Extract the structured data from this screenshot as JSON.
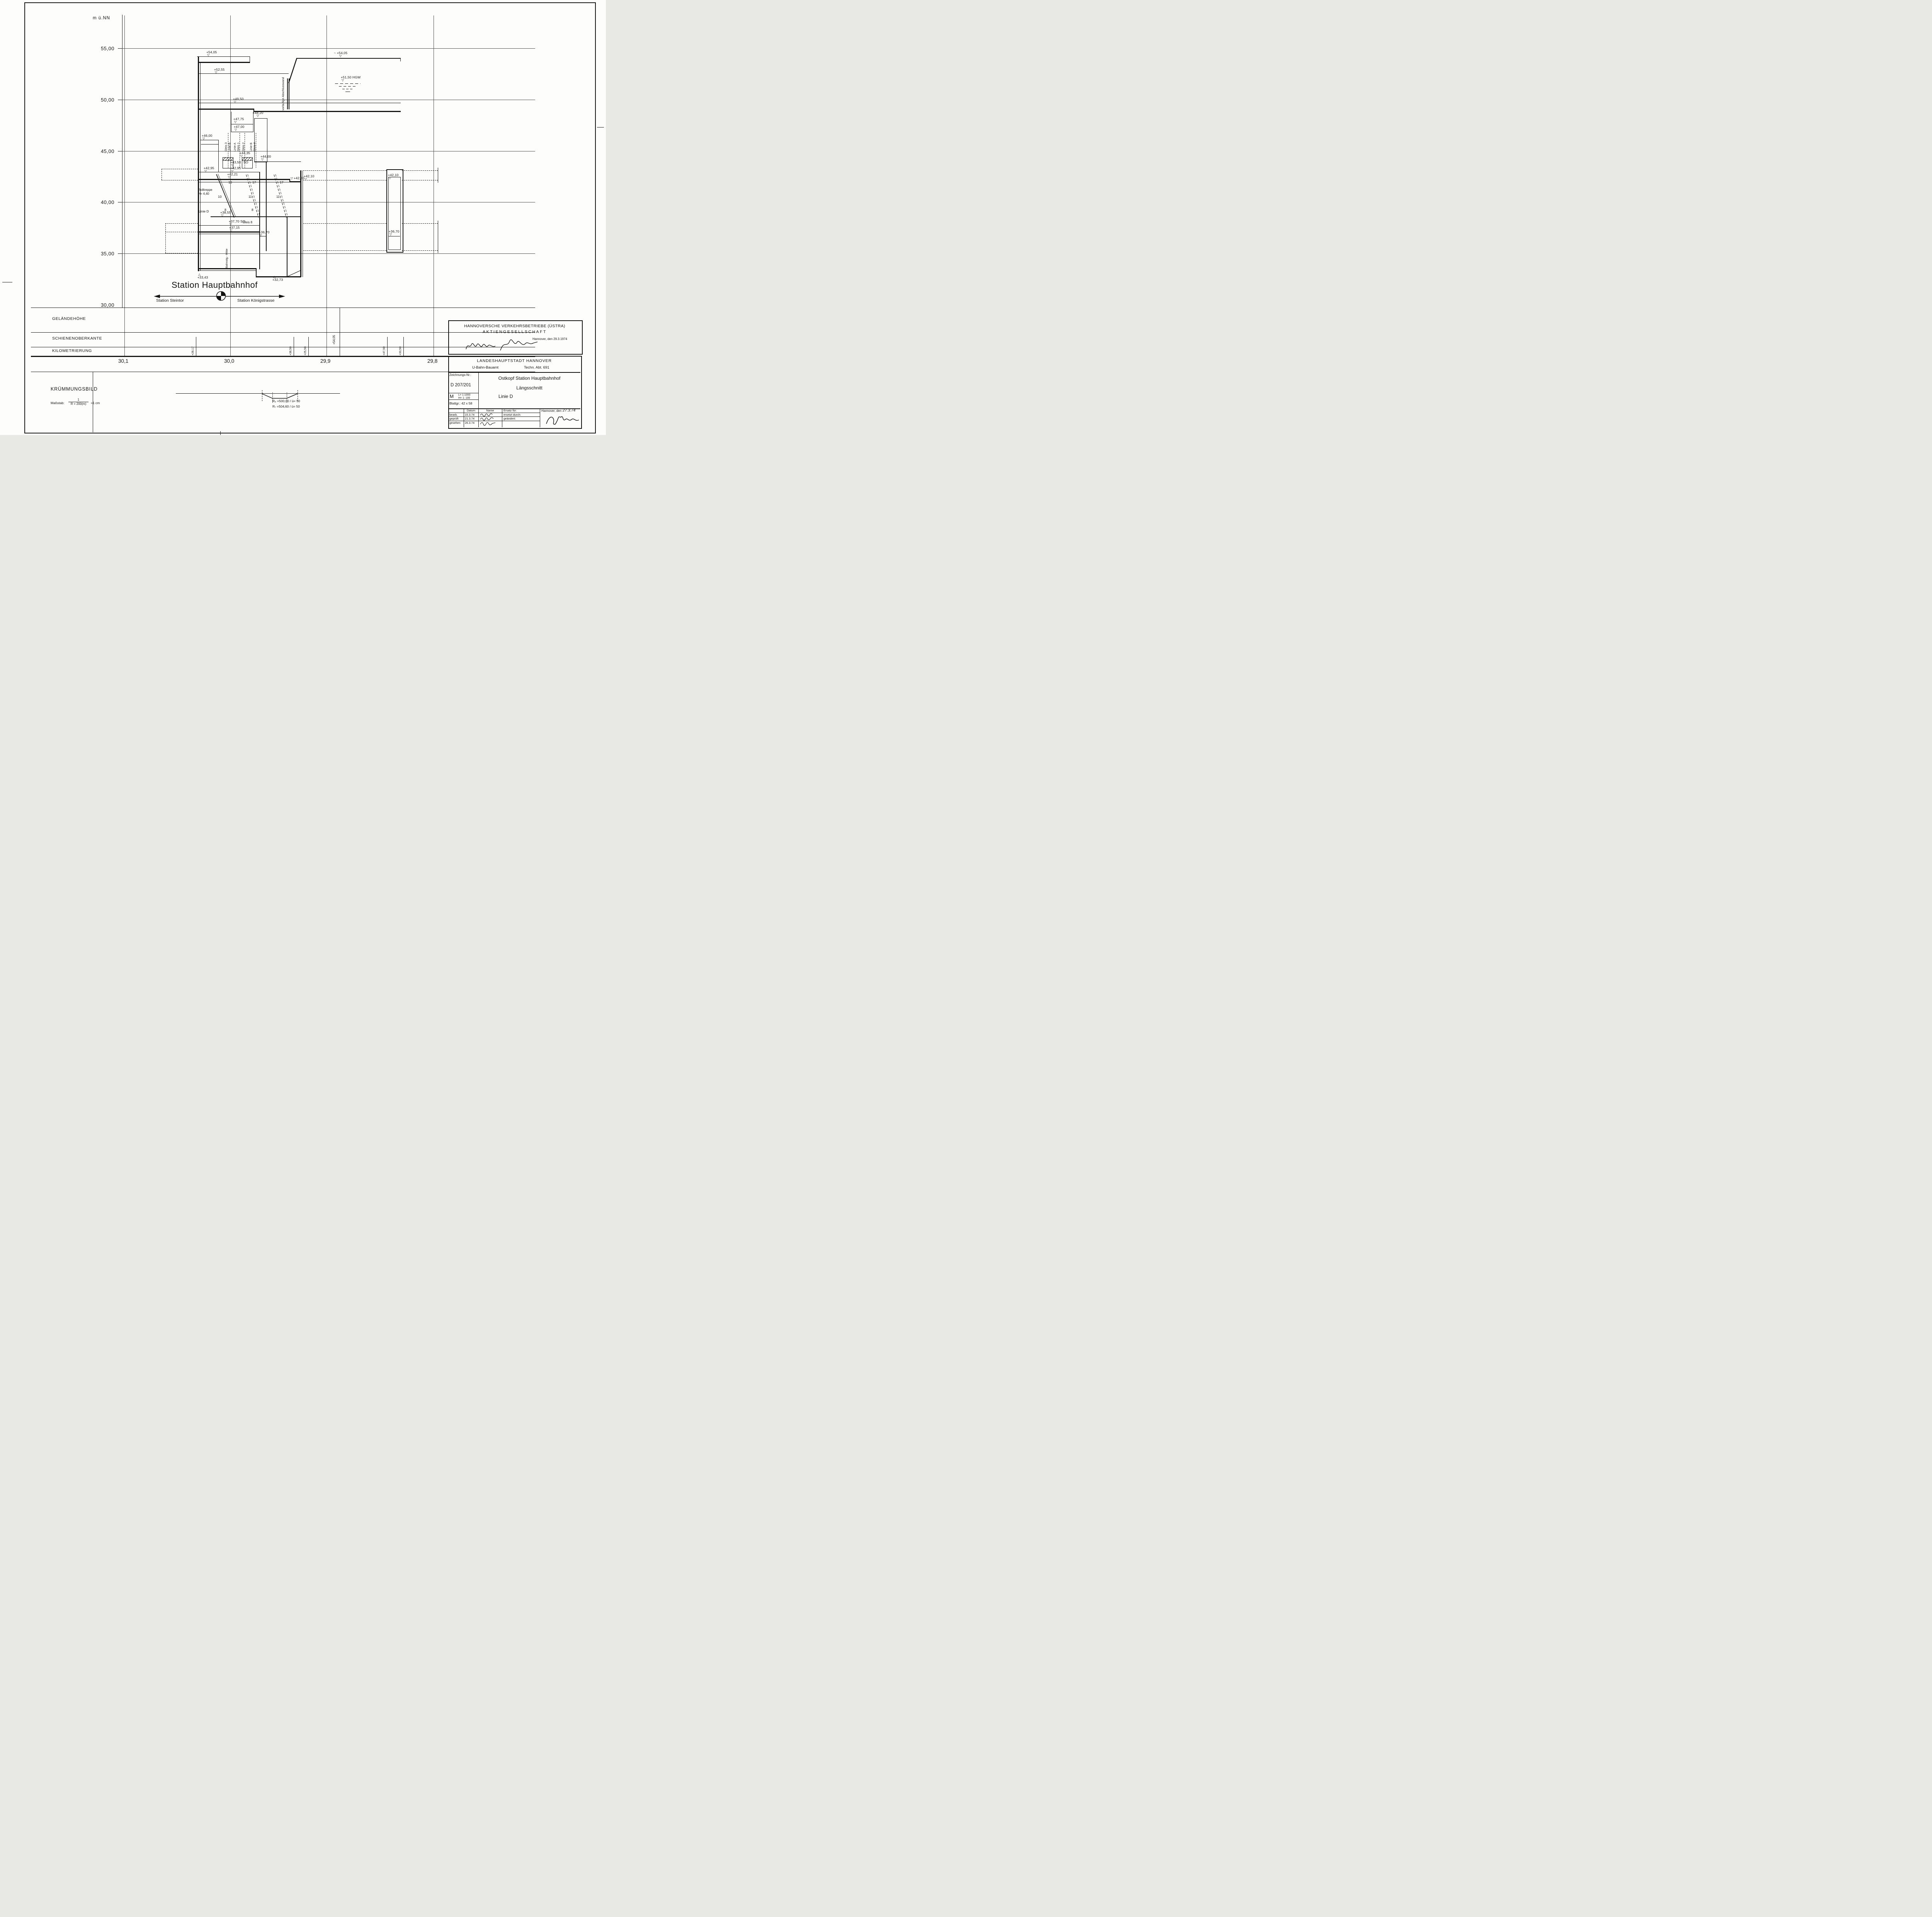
{
  "axis": {
    "unit": "m ü.NN",
    "elevations": [
      "55,00",
      "50,00",
      "45,00",
      "40,00",
      "35,00",
      "30,00"
    ],
    "km": [
      "30,1",
      "30,0",
      "29,9",
      "29,8"
    ]
  },
  "bands": {
    "rows": [
      "GELÄNDEHÖHE",
      "SCHIENENOBERKANTE",
      "KILOMETRIERUNG"
    ],
    "km_marks": [
      "+28,17",
      "+38,50",
      "+25,50",
      "+47,50",
      "+33,50"
    ],
    "surface_mark": "+54,05"
  },
  "station": {
    "title": "Station Hauptbahnhof",
    "prev_station": "Station Steintor",
    "next_station": "Station Königstrasse",
    "wall_label": "vorläufige Abschlusswand",
    "marks": [
      "+54,05",
      "+52,55",
      "~ +54,05",
      "+51,50  HGW",
      "+49,50",
      "+48,20",
      "+47,75",
      "+47,00",
      "+46,00",
      "+44,35",
      "+43,50",
      "SO",
      "+42,95",
      "+42,95",
      "+44,00",
      "+42,21",
      "+42,00",
      "+42,10",
      "+38,55",
      "+37,70 SO",
      "+37,15",
      "+36,70",
      "+42,10",
      "+36,70",
      "+33,43",
      "+32,73"
    ],
    "tracks": [
      {
        "a": "Gleis 3",
        "b": "Linie B"
      },
      {
        "a": "Linie A",
        "b": "Gleis 1"
      },
      {
        "a": "Gleis 2"
      },
      {
        "a": "Linie B",
        "b": "Gleis 4"
      }
    ],
    "rolltreppe": "Rolltreppe",
    "rolltreppe_h": "H= 4,40",
    "linie_d": "Linie D",
    "gleis8": "Gleis 8",
    "bahnstg": "Bahnstg.- Mitte",
    "stairs": [
      "10",
      "17",
      "17",
      "10",
      "11",
      "11",
      "8",
      "8"
    ]
  },
  "kruemmung": {
    "title": "KRÜMMUNGSBILD",
    "massstab": "Maßstab:",
    "frac_num": "1",
    "frac_den": "R = 200(m)",
    "eq": "=1 cm",
    "r8": "R₈ =500,00 / ü= 50",
    "r7": "R₇ =504,60 / ü= 50"
  },
  "ustra": {
    "line1": "HANNOVERSCHE VERKEHRSBETRIEBE (ÜSTRA)",
    "line2": "AKTIENGESELLSCHAFT",
    "date": "Hannover, den 29.3.1974"
  },
  "stadt": {
    "city": "LANDESHAUPTSTADT HANNOVER",
    "amt": "U-Bahn-Bauamt",
    "abt": "Techn. Abt. 691",
    "z_label": "Zeichnungs-Nr.:",
    "z_nr": "D 207/201",
    "title1": "Ostkopf Station Hauptbahnhof",
    "title2": "Längsschnitt",
    "title3": "Linie D",
    "m": "M",
    "scale_l": "L= 1:1000",
    "scale_h": "H= 1: 100",
    "blatt": "Blattgr.: 42 x 58"
  },
  "table": {
    "c_datum": "Datum",
    "c_name": "Name",
    "c_ersatz": "Ersatz für:",
    "r1": "bearb.",
    "d1": "15.3.74",
    "r2": "geprüft",
    "d2": "21.3.74",
    "r3": "gesehen",
    "d3": "26.3.74",
    "ersetzt": "ersetzt durch:",
    "geaendert": "geändert:",
    "ort": "Hannover, den",
    "datum_hand": "27.3.74"
  }
}
